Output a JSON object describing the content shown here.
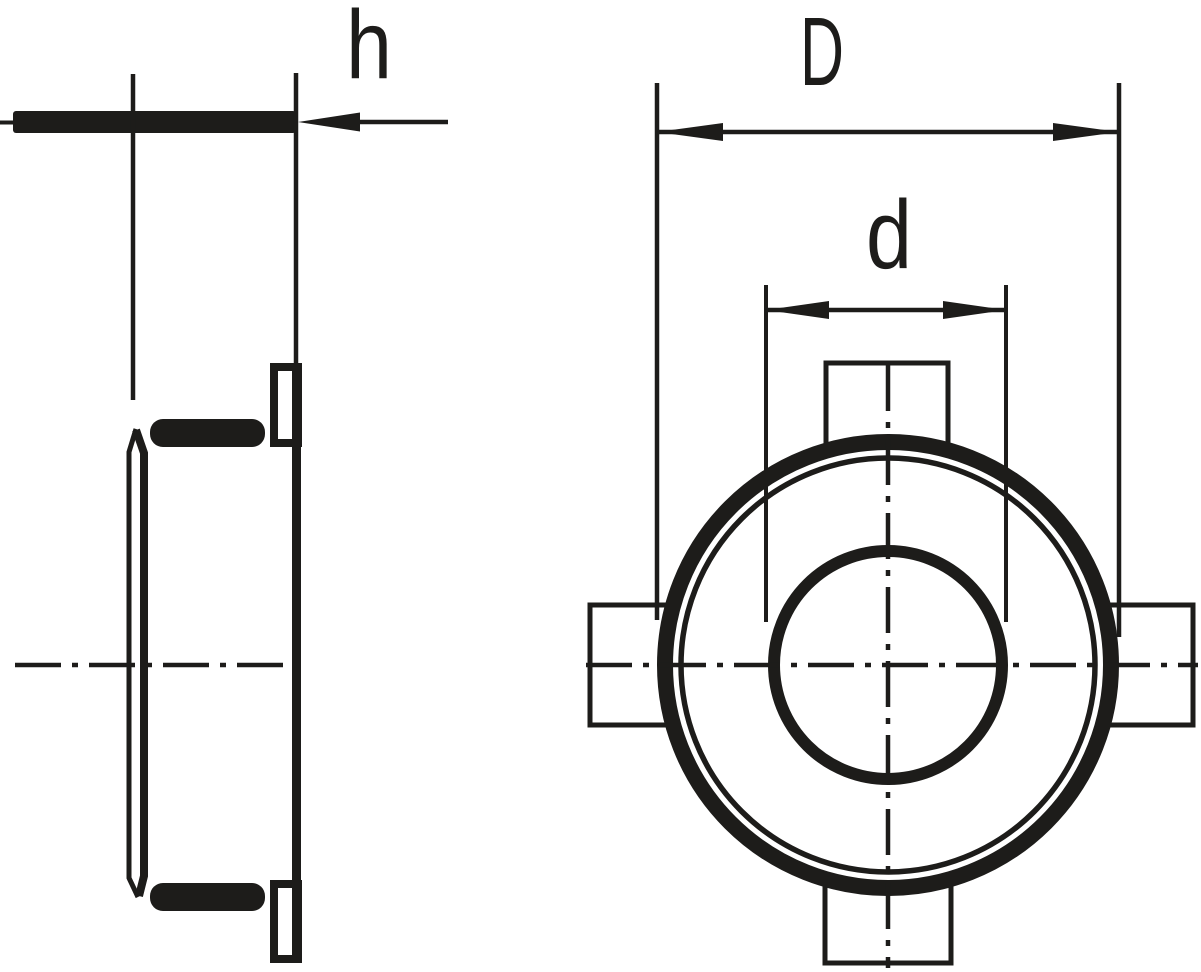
{
  "drawing": {
    "type": "technical-dimension-drawing",
    "views": {
      "side_view": "locknut shown from the side (height h)",
      "front_view": "locknut shown from the front with four lugs (outer diameter D, bore diameter d)"
    },
    "labels": {
      "h": "h",
      "D": "D",
      "d": "d"
    },
    "colors": {
      "line": "#1d1c1a",
      "background": "#ffffff"
    }
  }
}
